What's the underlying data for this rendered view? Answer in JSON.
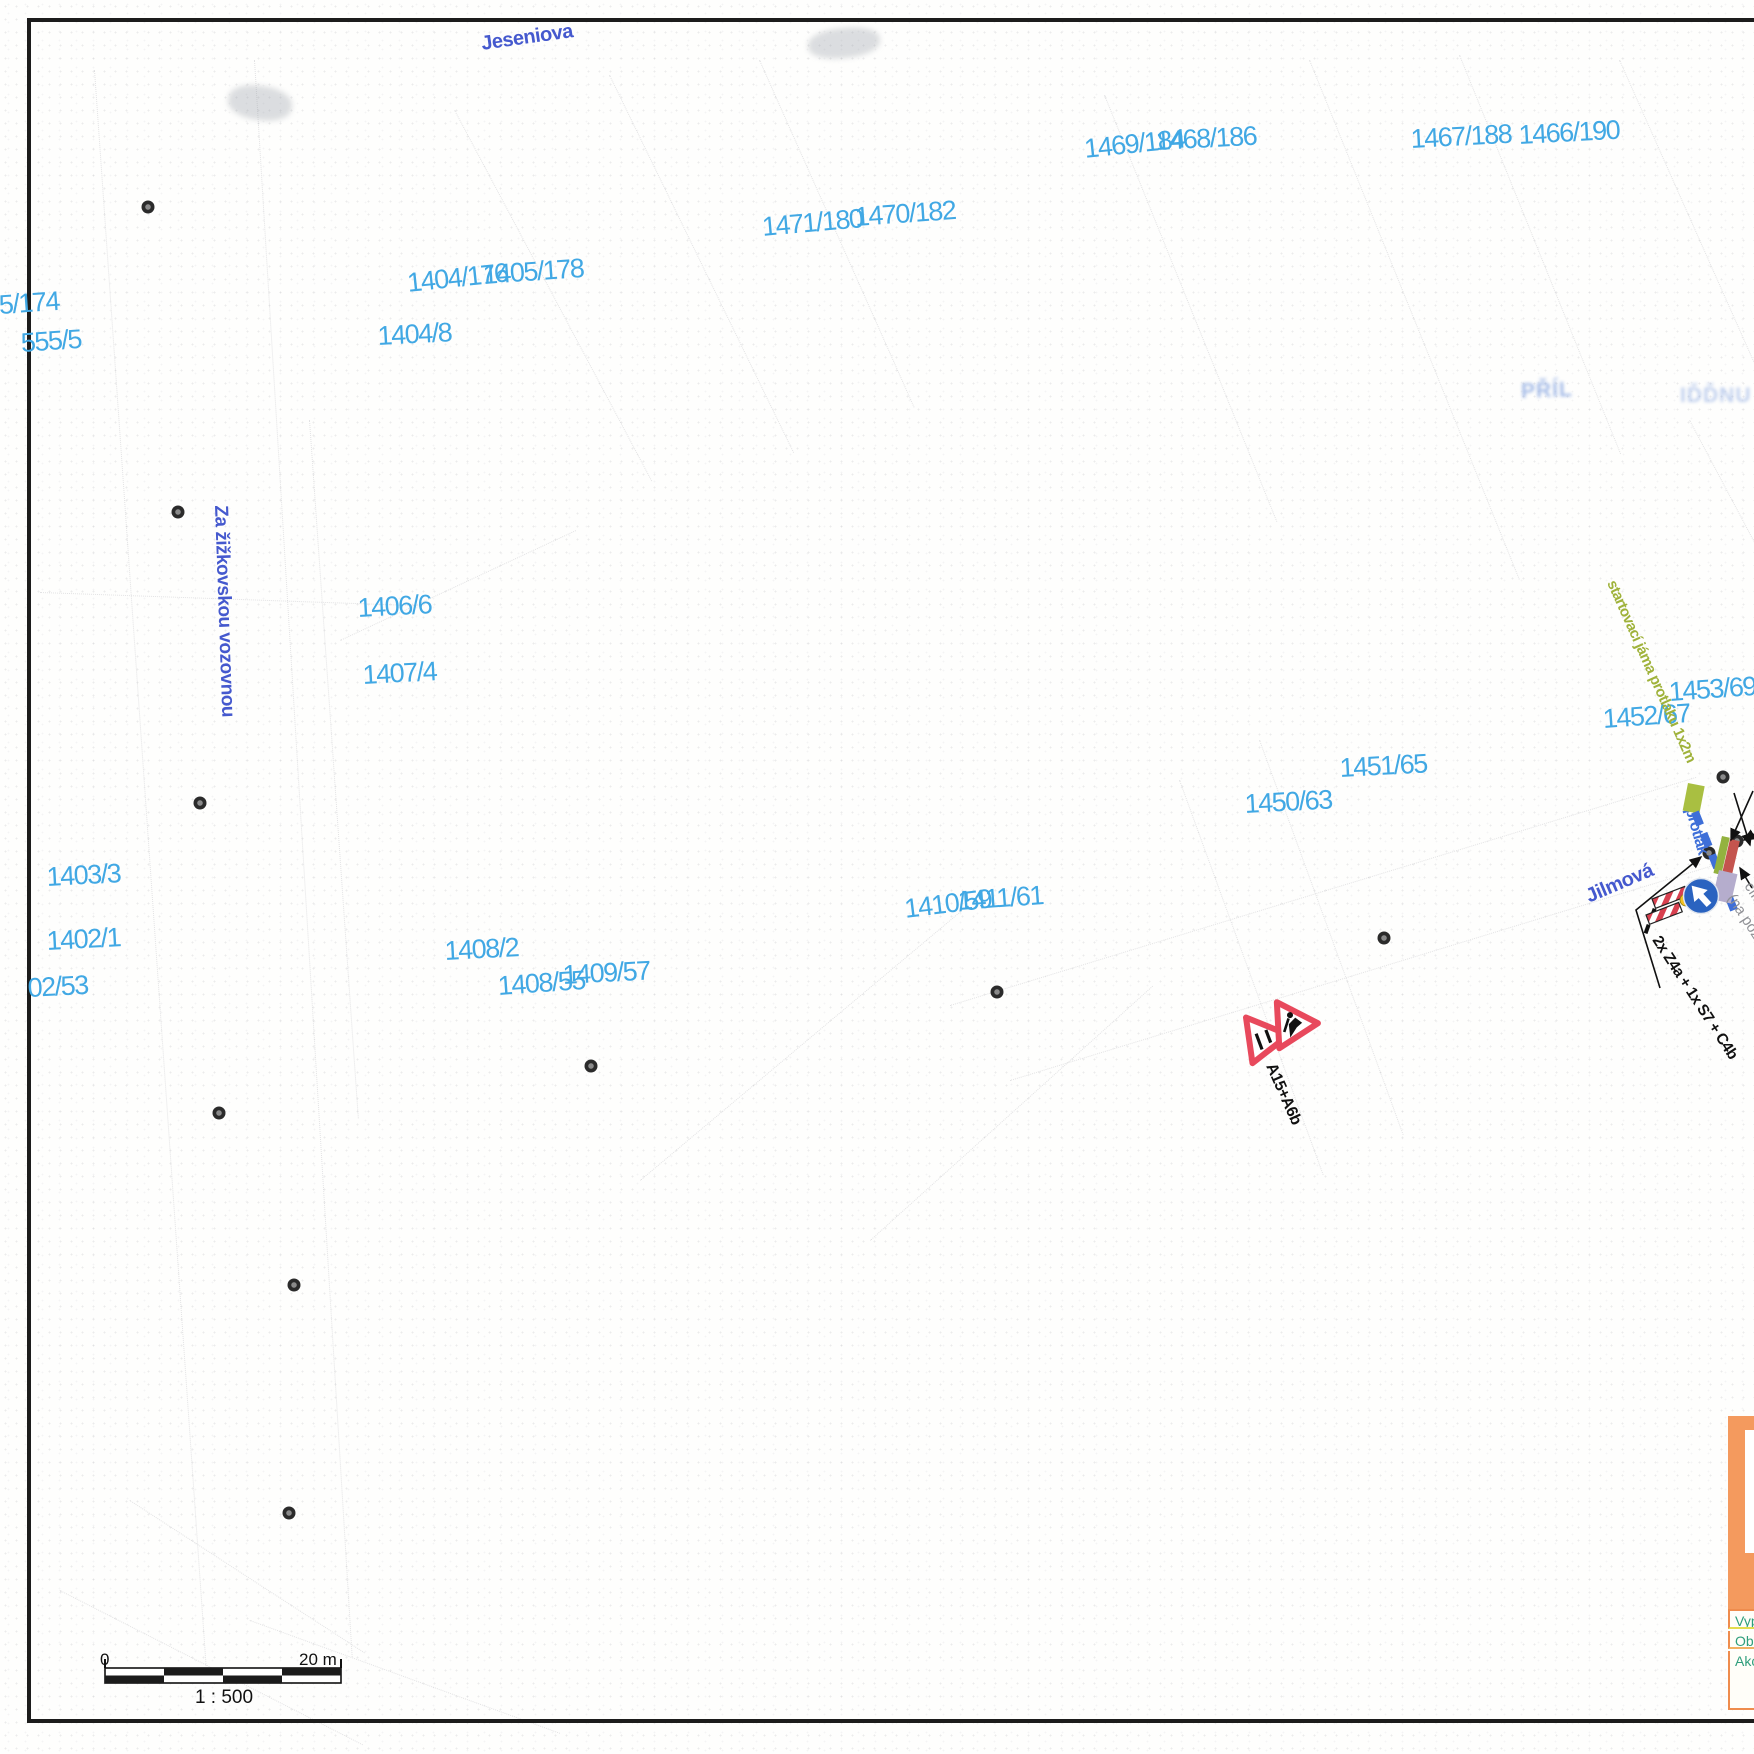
{
  "document_type": "traffic-engineering site plan over cadastral map",
  "colors": {
    "parcel_label": "#41a8e4",
    "street_label": "#4559ce",
    "jama_green": "#a9bf41",
    "protlak_blue": "#3e6fd8",
    "sign_red": "#e8495c",
    "titleblock_orange": "#f49a5e",
    "titleblock_text_teal": "#2f9e7c"
  },
  "streets": [
    {
      "name": "Jeseniova",
      "x": 480,
      "y": 34,
      "rot": -8,
      "size": 20
    },
    {
      "name": "Za žižkovskou vozovnou",
      "x": 230,
      "y": 505,
      "rot": 88,
      "size": 19
    },
    {
      "name": "Jilmová",
      "x": 1583,
      "y": 888,
      "rot": -23,
      "size": 20
    }
  ],
  "parcels": [
    {
      "label": "5/174",
      "x": -2,
      "y": 292,
      "rot": -4
    },
    {
      "label": "555/5",
      "x": 20,
      "y": 330,
      "rot": -4
    },
    {
      "label": "1404/176",
      "x": 406,
      "y": 270,
      "rot": -6
    },
    {
      "label": "1405/178",
      "x": 482,
      "y": 262,
      "rot": -4
    },
    {
      "label": "1404/8",
      "x": 377,
      "y": 323,
      "rot": -3
    },
    {
      "label": "1471/180",
      "x": 761,
      "y": 214,
      "rot": -5
    },
    {
      "label": "1470/182",
      "x": 854,
      "y": 204,
      "rot": -4
    },
    {
      "label": "1469/184",
      "x": 1083,
      "y": 136,
      "rot": -6
    },
    {
      "label": "1468/186",
      "x": 1155,
      "y": 128,
      "rot": -3
    },
    {
      "label": "1467/188",
      "x": 1410,
      "y": 126,
      "rot": -3
    },
    {
      "label": "1466/190",
      "x": 1518,
      "y": 122,
      "rot": -3
    },
    {
      "label": "1406/6",
      "x": 357,
      "y": 595,
      "rot": -3
    },
    {
      "label": "1407/4",
      "x": 362,
      "y": 662,
      "rot": -3
    },
    {
      "label": "1403/3",
      "x": 46,
      "y": 864,
      "rot": -3
    },
    {
      "label": "1402/1",
      "x": 46,
      "y": 928,
      "rot": -3
    },
    {
      "label": "02/53",
      "x": 27,
      "y": 975,
      "rot": -3
    },
    {
      "label": "1408/2",
      "x": 444,
      "y": 938,
      "rot": -3
    },
    {
      "label": "1408/55",
      "x": 497,
      "y": 973,
      "rot": -4
    },
    {
      "label": "1409/57",
      "x": 562,
      "y": 962,
      "rot": -3
    },
    {
      "label": "1410/59",
      "x": 903,
      "y": 896,
      "rot": -7
    },
    {
      "label": "1411/61",
      "x": 957,
      "y": 888,
      "rot": -4
    },
    {
      "label": "1450/63",
      "x": 1244,
      "y": 791,
      "rot": -3
    },
    {
      "label": "1451/65",
      "x": 1339,
      "y": 755,
      "rot": -3
    },
    {
      "label": "1452/67",
      "x": 1602,
      "y": 706,
      "rot": -4
    },
    {
      "label": "1453/69",
      "x": 1668,
      "y": 679,
      "rot": -4
    }
  ],
  "survey_dots": [
    {
      "x": 148,
      "y": 207
    },
    {
      "x": 178,
      "y": 512
    },
    {
      "x": 200,
      "y": 803
    },
    {
      "x": 219,
      "y": 1113
    },
    {
      "x": 294,
      "y": 1285
    },
    {
      "x": 289,
      "y": 1513
    },
    {
      "x": 591,
      "y": 1066
    },
    {
      "x": 997,
      "y": 992
    },
    {
      "x": 1384,
      "y": 938
    },
    {
      "x": 1723,
      "y": 777
    },
    {
      "x": 1709,
      "y": 853
    },
    {
      "x": 1737,
      "y": 841
    }
  ],
  "annotations": {
    "startovaci_jama": "startovací jáma protlaku 1x2m",
    "protlak": "protlak",
    "signs_group": "2x Z4a + 1x S7 + C4b",
    "warning_signs": "A15+A6b",
    "cilova_line1": "cílová jáma",
    "cilova_line2": "(na pozemku"
  },
  "scalebar": {
    "left_label": "0",
    "right_label": "20 m",
    "ratio": "1 : 500"
  },
  "titleblock": {
    "rows": [
      {
        "label": "Vyp"
      },
      {
        "label": "Obj"
      },
      {
        "label": "Akc"
      }
    ]
  },
  "faint_fragments": [
    {
      "text": "PŘÍL"
    },
    {
      "text": "IĎĎNU"
    }
  ]
}
